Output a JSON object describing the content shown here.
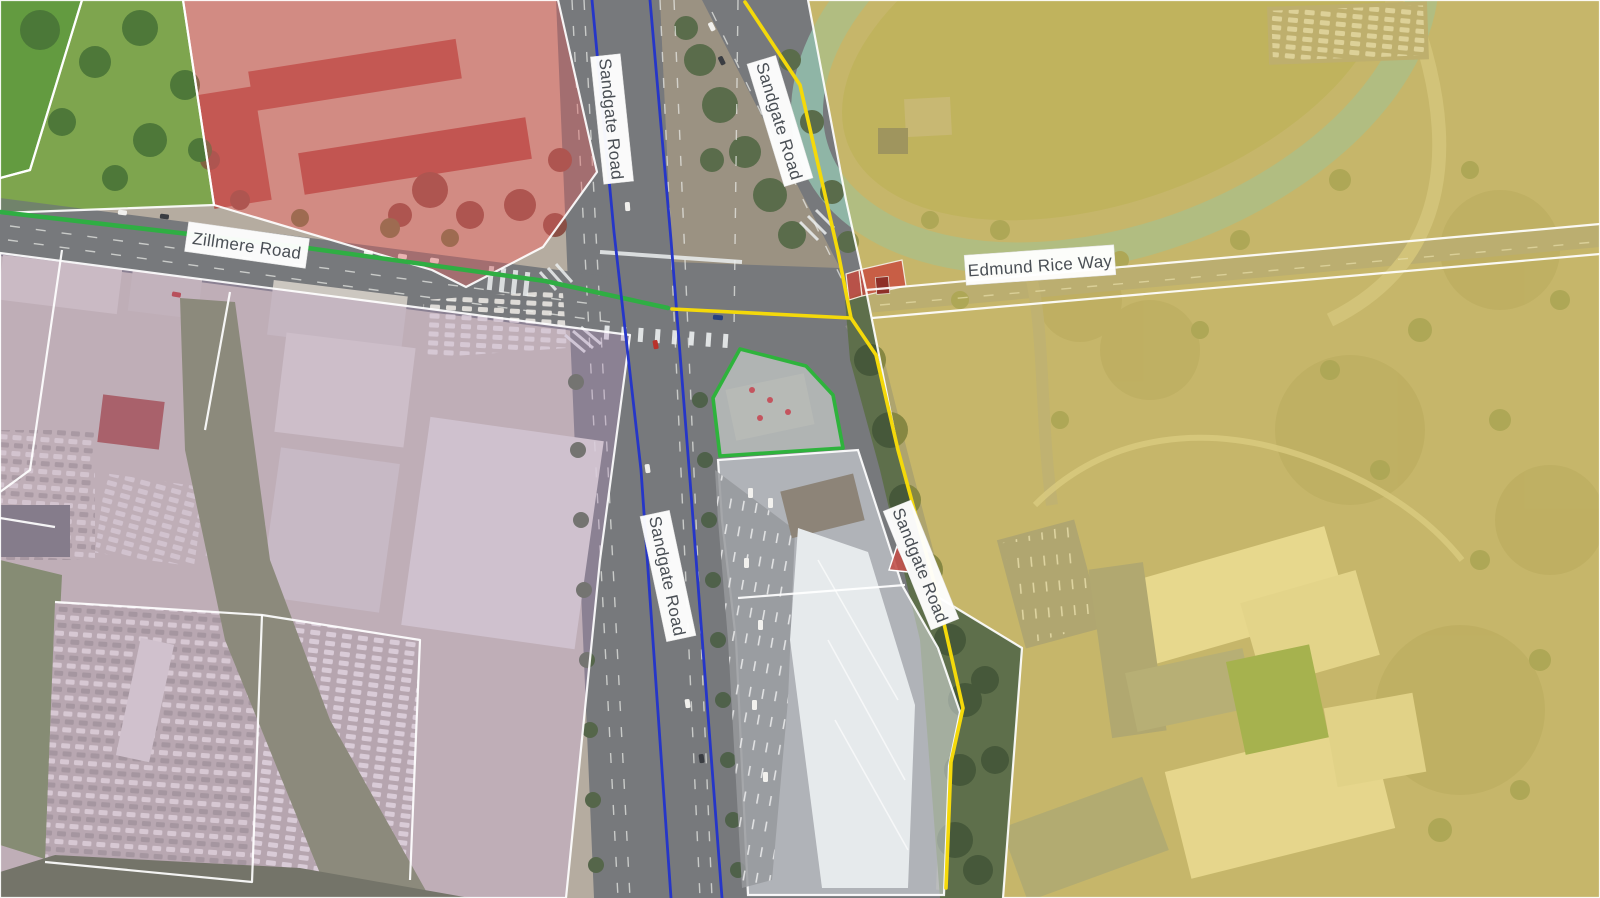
{
  "map": {
    "type": "aerial-zoning-map",
    "road_labels": [
      {
        "name": "sandgate-road-north",
        "text": "Sandgate Road"
      },
      {
        "name": "sandgate-road-northeast",
        "text": "Sandgate Road"
      },
      {
        "name": "sandgate-road-south",
        "text": "Sandgate Road"
      },
      {
        "name": "sandgate-road-southeast",
        "text": "Sandgate Road"
      },
      {
        "name": "zillmere-road",
        "text": "Zillmere Road"
      },
      {
        "name": "edmund-rice-way",
        "text": "Edmund Rice Way"
      }
    ],
    "zones": [
      {
        "name": "open-space-green",
        "color": "#5ea832"
      },
      {
        "name": "residential-red",
        "color": "#e06060"
      },
      {
        "name": "industrial-purple",
        "color": "#b992c4"
      },
      {
        "name": "community-yellow",
        "color": "#e0c94f"
      },
      {
        "name": "centre-light",
        "color": "#e9eef3"
      },
      {
        "name": "highlighted-parcel-outline",
        "color": "#2eb33c"
      }
    ],
    "route_lines": [
      {
        "name": "blue-route",
        "color": "#2636c8"
      },
      {
        "name": "yellow-route",
        "color": "#f4d90a"
      },
      {
        "name": "green-route",
        "color": "#2fae43"
      }
    ],
    "markers": [
      {
        "name": "red-highlight-parcels",
        "color": "#c8483c"
      }
    ]
  }
}
